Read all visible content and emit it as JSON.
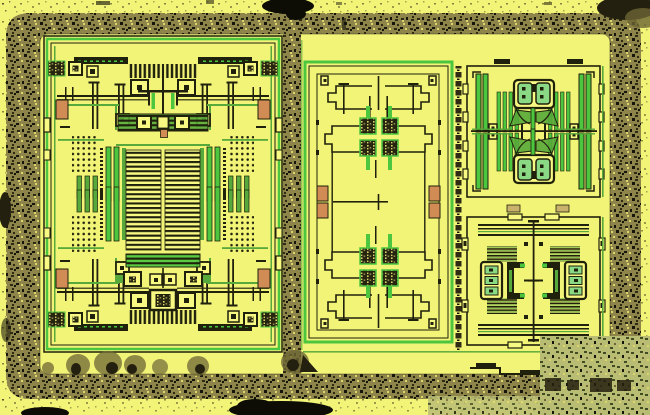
{
  "meta": {
    "title": "Integrated circuit die microscope photograph",
    "description": "Die shot of an analog IC: yellow passivated surface, dark speckled seal ring with rounded corners, a large symmetric analog core block on the left, a transistor-array block in the middle, two output cell blocks on the right, and contamination stains along the edges."
  },
  "palette": {
    "bg_yellow": "#f2f478",
    "bg_yellow_bright": "#f7f983",
    "ring_base": "#8d854a",
    "speck_dark": "#2e2a14",
    "speck_black": "#15140a",
    "speck_light": "#dbd56a",
    "outline_dark": "#20210c",
    "trace_green": "#56a93a",
    "trace_green_bright": "#4cc63e",
    "trace_green_dark": "#2e7a26",
    "pad_orange": "#d18b54",
    "tan": "#c9b26b",
    "eye_green": "#8ad985",
    "pad_base": "#26250f",
    "corner_base": "#b9bd74",
    "corner_dark": "#414b24",
    "stain_olive": "#6d6535",
    "stain_dark": "#23200f",
    "blob_black": "#0d0d05"
  },
  "regions": {
    "seal_ring": "seal-ring",
    "divider": "scribe-divider",
    "left_block": "analog-core-block",
    "middle_block": "transistor-array-block",
    "right_top_block": "output-cell-top",
    "right_bottom_block": "output-cell-bottom",
    "label_column": "micro-label-column",
    "stains": "surface-stains"
  }
}
